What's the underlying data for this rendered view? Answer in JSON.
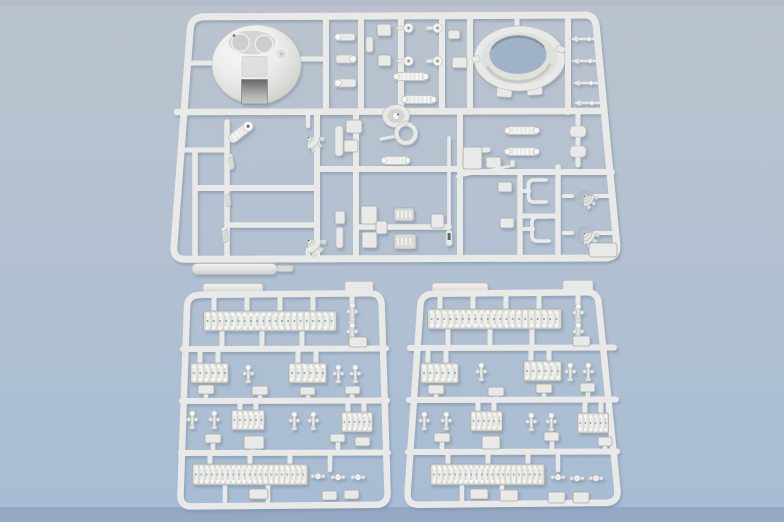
{
  "scene": {
    "title": "Plastic model kit sprues",
    "subject": "Three light-gray injection-molded styrene sprues of an armored-vehicle model kit photographed on a blue-gray backdrop",
    "sprue_count": 3
  },
  "colors": {
    "bg_top": "#bac3cd",
    "bg_upper": "#b4c1d0",
    "bg_lower": "#adbfd3",
    "bg_bottom": "#a7bcd3",
    "bg_strip": "#93a9c4",
    "bg_topline": "#b0bac6",
    "plastic": "#e9eae7",
    "plastic_light": "#f6f6f4",
    "plastic_mid": "#d8dad6",
    "plastic_shadow": "#c0c3bf",
    "plastic_deep": "#a7aaa6",
    "dark_detail": "#63666a",
    "hole": "#9fb2c7",
    "shadow": "#75889e",
    "track_base": "#d8dad6",
    "track_seg": "#edeeea",
    "track_dot": "#f7f7f5",
    "track_mid": "#a0a49f"
  },
  "sprues": {
    "top": {
      "label": "main parts sprue",
      "parts": [
        "turret dome with twin hatches",
        "turret race ring",
        "2 toothed sprocket gears",
        "2 hubbed sprocket wheels",
        "3 road-wheel hub cylinders",
        "angled ribbed cylinder",
        "4 round-head periscope pins",
        "2 ribbed coupling rods",
        "2 ribbed muffler rods",
        "thin gun-barrel rod",
        "thin sighting rod",
        "2 C-shaped brackets",
        "4 arrow-tipped pins",
        "assorted clamps and mounting pads",
        "long fender bar"
      ]
    },
    "bottom_left": {
      "label": "track-link sprue A",
      "parts": [
        "long track-link strip top",
        "long track-link strip bottom",
        "4 short track-link blocks",
        "8 end-connector pins",
        "3 cross pins",
        "12 mounting pads",
        "flat bar on top rail",
        "small plate on top rail"
      ]
    },
    "bottom_right": {
      "label": "track-link sprue B",
      "parts": [
        "long track-link strip top",
        "long track-link strip bottom",
        "4 short track-link blocks",
        "8 end-connector pins",
        "3 cross pins",
        "12 mounting pads",
        "flat bar on top rail",
        "small plate on top rail"
      ]
    }
  }
}
